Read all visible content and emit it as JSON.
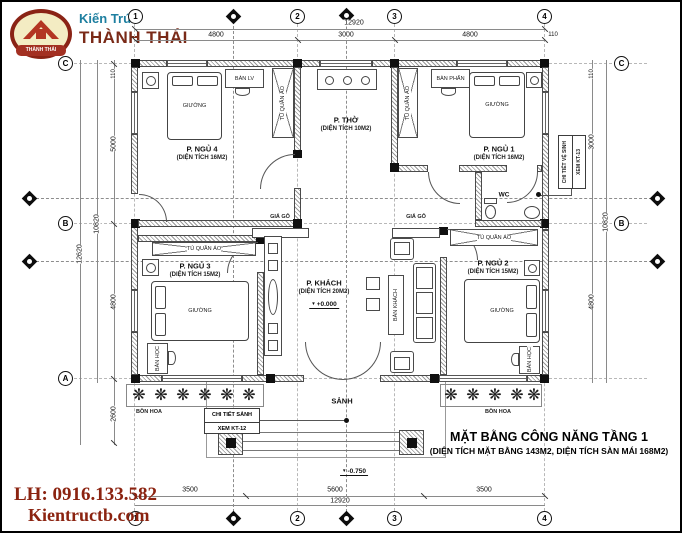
{
  "branding": {
    "tagline": "Kiến Trúc",
    "studio": "THÀNH THÁI",
    "emblem_banner": "THÀNH THÁI"
  },
  "contact": {
    "phone": "LH: 0916.133.582",
    "website": "Kientructb.com"
  },
  "title_block": {
    "line1": "MẶT BẰNG CÔNG NĂNG TẦNG 1",
    "line2": "(DIỆN TÍCH MẶT BẰNG 143M2, DIỆN TÍCH SÀN MÁI 168M2)"
  },
  "rooms": {
    "bedroom4": {
      "name": "P. NGỦ 4",
      "area": "(DIỆN TÍCH 16M2)"
    },
    "worship": {
      "name": "P. THỜ",
      "area": "(DIỆN TÍCH 10M2)"
    },
    "bedroom1": {
      "name": "P. NGỦ 1",
      "area": "(DIỆN TÍCH 16M2)"
    },
    "living": {
      "name": "P. KHÁCH",
      "area": "(DIỆN TÍCH 20M2)",
      "level": "+0.000"
    },
    "bedroom3": {
      "name": "P. NGỦ 3",
      "area": "(DIỆN TÍCH 15M2)"
    },
    "bedroom2": {
      "name": "P. NGỦ 2",
      "area": "(DIỆN TÍCH 15M2)"
    },
    "wc": {
      "name": "WC"
    },
    "porch": {
      "name": "SẢNH",
      "level": "-0.750"
    },
    "flowerbed": {
      "name": "BỒN HOA"
    }
  },
  "furniture": {
    "bed": "GIƯỜNG",
    "wardrobe": "TỦ QUẦN ÁO",
    "work_desk": "BÀN LV",
    "dressing_table": "BÀN PHẤN",
    "study_desk": "BÀN HỌC",
    "wood_shelf": "GIÁ GỖ",
    "coffee_table": "BÀN KHÁCH"
  },
  "callouts": {
    "porch_detail": {
      "line1": "CHI TIẾT SẢNH",
      "line2": "XEM KT-12"
    },
    "wc_detail": {
      "line1": "CHI TIẾT VỆ SINH",
      "line2": "XEM KT-13"
    }
  },
  "grid": {
    "col1": "1",
    "col2": "2",
    "col3": "3",
    "col4": "4",
    "rowA": "A",
    "rowB": "B",
    "rowC": "C"
  },
  "dimensions": {
    "top": {
      "seg1": "4800",
      "seg2": "3000",
      "seg3": "4800",
      "total": "12920",
      "end": "110"
    },
    "bottom": {
      "seg1": "3500",
      "seg2": "5600",
      "seg3": "3500",
      "total": "12920"
    },
    "left": {
      "end": "110",
      "seg1": "5000",
      "seg2": "4800",
      "total": "10820",
      "overall": "12620",
      "porch": "2600"
    },
    "right": {
      "end": "110",
      "seg1": "3000",
      "seg2": "4800",
      "total": "10820"
    }
  },
  "colors": {
    "brand_teal": "#1e7fa0",
    "brand_red": "#7a2a18",
    "contact_red": "#8b2310",
    "line": "#3c3c3c",
    "hatch": "#989898"
  }
}
